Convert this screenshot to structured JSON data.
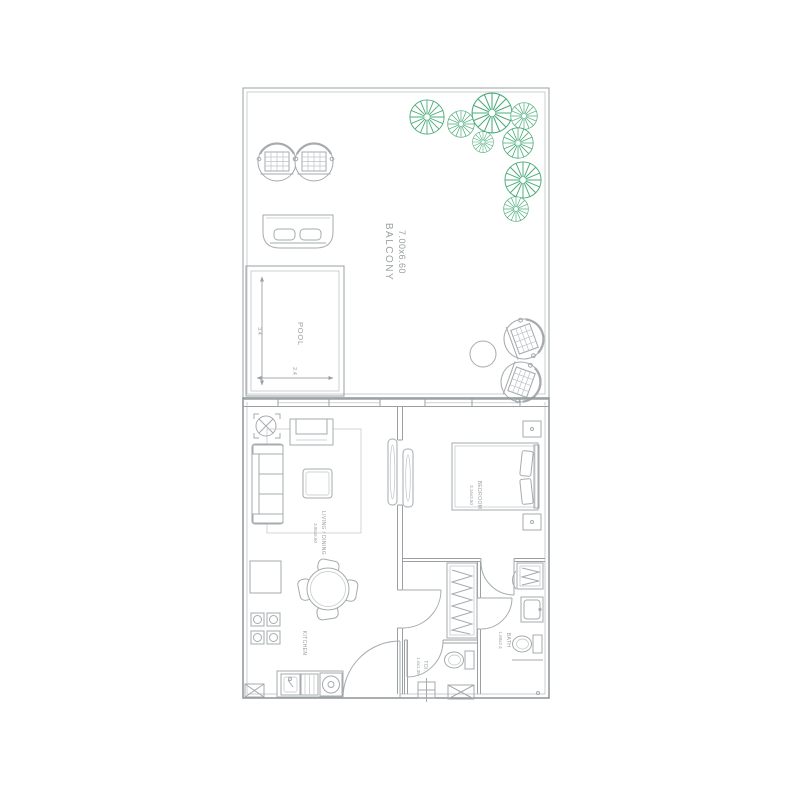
{
  "colors": {
    "tree_green": "#4aac79",
    "wall_grey": "#8d9396",
    "line_grey": "#a6abae",
    "text_grey": "#9aa0a3",
    "background": "#ffffff"
  },
  "plan": {
    "balcony": {
      "label": "BALCONY",
      "dims": "7.00x6.60"
    },
    "pool": {
      "label": "POOL",
      "dim_vertical": "3.4",
      "dim_horizontal": "2.4"
    },
    "living_dining": {
      "label": "LIVING / DINING",
      "dims": "3.85x6.60"
    },
    "bedroom": {
      "label": "BEDROOM",
      "dims": "3.16x3.50"
    },
    "kitchen": {
      "label": "KITCHEN"
    },
    "bath": {
      "label": "BATH",
      "dims": "1.60x2.4"
    },
    "toilet": {
      "label": "TOI.",
      "dims": "1.6x1.35"
    }
  }
}
